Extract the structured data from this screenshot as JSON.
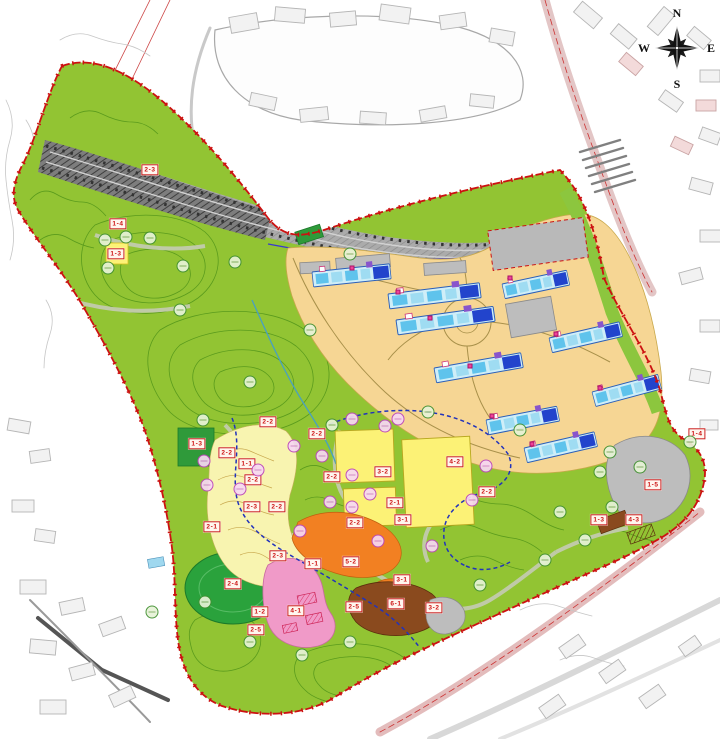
{
  "compass": {
    "letters": [
      {
        "label": "N",
        "x": 677,
        "y": 13
      },
      {
        "label": "E",
        "x": 711,
        "y": 48
      },
      {
        "label": "S",
        "x": 677,
        "y": 84
      },
      {
        "label": "W",
        "x": 644,
        "y": 48
      }
    ]
  },
  "zone_labels": [
    {
      "text": "2-3",
      "x": 150,
      "y": 170
    },
    {
      "text": "1-4",
      "x": 118,
      "y": 224
    },
    {
      "text": "1-3",
      "x": 116,
      "y": 254
    },
    {
      "text": "2-2",
      "x": 268,
      "y": 422
    },
    {
      "text": "2-2",
      "x": 317,
      "y": 434
    },
    {
      "text": "1-3",
      "x": 197,
      "y": 444
    },
    {
      "text": "2-2",
      "x": 227,
      "y": 453
    },
    {
      "text": "1-1",
      "x": 247,
      "y": 464
    },
    {
      "text": "2-2",
      "x": 253,
      "y": 480
    },
    {
      "text": "2-2",
      "x": 332,
      "y": 477
    },
    {
      "text": "3-2",
      "x": 383,
      "y": 472
    },
    {
      "text": "4-2",
      "x": 455,
      "y": 462
    },
    {
      "text": "2-2",
      "x": 487,
      "y": 492
    },
    {
      "text": "2-3",
      "x": 252,
      "y": 507
    },
    {
      "text": "2-2",
      "x": 277,
      "y": 507
    },
    {
      "text": "2-1",
      "x": 212,
      "y": 527
    },
    {
      "text": "2-1",
      "x": 395,
      "y": 503
    },
    {
      "text": "3-1",
      "x": 403,
      "y": 520
    },
    {
      "text": "2-2",
      "x": 355,
      "y": 523
    },
    {
      "text": "2-3",
      "x": 278,
      "y": 556
    },
    {
      "text": "1-1",
      "x": 313,
      "y": 564
    },
    {
      "text": "5-2",
      "x": 351,
      "y": 562
    },
    {
      "text": "2-4",
      "x": 233,
      "y": 584
    },
    {
      "text": "3-1",
      "x": 402,
      "y": 580
    },
    {
      "text": "4-1",
      "x": 296,
      "y": 611
    },
    {
      "text": "1-2",
      "x": 260,
      "y": 612
    },
    {
      "text": "2-5",
      "x": 256,
      "y": 630
    },
    {
      "text": "6-1",
      "x": 396,
      "y": 604
    },
    {
      "text": "3-2",
      "x": 434,
      "y": 608
    },
    {
      "text": "2-5",
      "x": 354,
      "y": 607
    },
    {
      "text": "1-4",
      "x": 697,
      "y": 434
    },
    {
      "text": "1-5",
      "x": 653,
      "y": 485
    },
    {
      "text": "1-3",
      "x": 599,
      "y": 520
    },
    {
      "text": "4-3",
      "x": 634,
      "y": 520
    }
  ],
  "markers": {
    "trees": [
      [
        105,
        240
      ],
      [
        126,
        237
      ],
      [
        150,
        238
      ],
      [
        183,
        266
      ],
      [
        108,
        268
      ],
      [
        235,
        262
      ],
      [
        180,
        310
      ],
      [
        350,
        254
      ],
      [
        310,
        330
      ],
      [
        250,
        382
      ],
      [
        203,
        420
      ],
      [
        332,
        425
      ],
      [
        428,
        412
      ],
      [
        520,
        430
      ],
      [
        560,
        512
      ],
      [
        610,
        452
      ],
      [
        640,
        467
      ],
      [
        600,
        472
      ],
      [
        612,
        507
      ],
      [
        690,
        442
      ],
      [
        480,
        585
      ],
      [
        350,
        642
      ],
      [
        302,
        655
      ],
      [
        250,
        642
      ],
      [
        205,
        602
      ],
      [
        585,
        540
      ],
      [
        545,
        560
      ],
      [
        152,
        612
      ]
    ],
    "flowers": [
      [
        204,
        461
      ],
      [
        207,
        485
      ],
      [
        240,
        489
      ],
      [
        258,
        470
      ],
      [
        294,
        446
      ],
      [
        322,
        456
      ],
      [
        330,
        502
      ],
      [
        352,
        507
      ],
      [
        385,
        426
      ],
      [
        352,
        419
      ],
      [
        398,
        419
      ],
      [
        378,
        541
      ],
      [
        300,
        531
      ],
      [
        432,
        546
      ],
      [
        472,
        500
      ],
      [
        486,
        466
      ],
      [
        352,
        475
      ],
      [
        370,
        494
      ]
    ],
    "flags": [
      [
        352,
        268
      ],
      [
        398,
        292
      ],
      [
        430,
        318
      ],
      [
        470,
        366
      ],
      [
        510,
        278
      ],
      [
        556,
        334
      ],
      [
        600,
        388
      ],
      [
        492,
        416
      ],
      [
        532,
        444
      ]
    ]
  },
  "colors": {
    "site_boundary": "#cc1111",
    "parkland_green": "#92c433",
    "contour_green": "#55971b",
    "development_tan": "#f6d694",
    "corridor_gray": "#a9a9a9",
    "yellow_field": "#fcf276",
    "slope_yellow": "#f8f4b0",
    "orange_zone": "#f28022",
    "brown_zone": "#8a4a1e",
    "pink_zone": "#f09ac8",
    "sports_field_green": "#2aa23c",
    "path_blue": "#2233bb",
    "building_cyan": "#cfeef8",
    "building_blue": "#2244cc",
    "building_purple": "#8855cc"
  }
}
